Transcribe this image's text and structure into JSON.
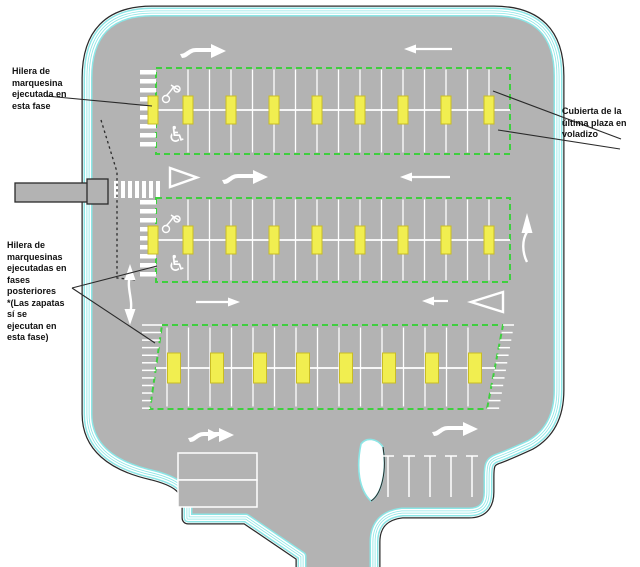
{
  "colors": {
    "gray": "#b3b3b3",
    "cyan": "#8ce6e6",
    "green": "#3ecf3e",
    "yellow": "#f1ee50",
    "yellow_border": "#c9bc24",
    "line": "#2a2a2a",
    "white": "#ffffff",
    "text": "#111111"
  },
  "icons": {
    "wheelchair": "♿"
  },
  "annotations": {
    "canopy_this_phase": {
      "lines": [
        "Hilera de",
        "marquesina",
        "ejecutada en",
        "esta fase"
      ]
    },
    "canopy_later_phases": {
      "lines": [
        "Hilera de",
        "marquesinas",
        "ejecutadas en",
        "fases",
        "posteriores",
        "*(Las zapatas",
        "sí se",
        "ejecutan en",
        "esta fase)"
      ]
    },
    "cantilever_cover": {
      "lines": [
        "Cubierta de la",
        "última plaza en",
        "voladizo"
      ]
    }
  },
  "plan": {
    "site_path": "M 88,78 Q 88,12 152,12 L 494,12 Q 558,12 558,76 L 558,390 Q 558,428 530,444 Q 506,455 497,458 C 489,461 488,465 488,477 L 488,492 C 488,506 481,512 469,512 L 402,512 C 384,514 374,524 374,542 L 374,580 L 302,580 L 302,556 L 246,518 L 188,518 L 188,504 C 188,488 176,480 152,474 C 112,465 88,446 88,414 Z",
    "rows": [
      {
        "type": "rect",
        "x1": 156,
        "y1": 68,
        "x2": 510,
        "y2": 154,
        "cy": 110,
        "div_start": 188,
        "div_gap": 21.5,
        "div_end": 490,
        "posts": [
          153,
          188,
          231,
          274,
          317,
          360,
          403,
          446,
          489
        ],
        "post_w": 10,
        "post_h": 28,
        "hatch": {
          "x": 140,
          "w": 16
        },
        "symbols": {
          "moto": [
            172,
            92
          ],
          "wheel": [
            177,
            134
          ]
        }
      },
      {
        "type": "rect",
        "x1": 156,
        "y1": 198,
        "x2": 510,
        "y2": 282,
        "cy": 240,
        "div_start": 188,
        "div_gap": 21.5,
        "div_end": 490,
        "posts": [
          153,
          188,
          231,
          274,
          317,
          360,
          403,
          446,
          489
        ],
        "post_w": 10,
        "post_h": 28,
        "hatch": {
          "x": 140,
          "w": 16
        },
        "symbols": {
          "moto": [
            172,
            222
          ],
          "wheel": [
            177,
            263
          ]
        }
      },
      {
        "type": "trap",
        "pts": [
          [
            162,
            325
          ],
          [
            503,
            325
          ],
          [
            487,
            409
          ],
          [
            150,
            409
          ]
        ],
        "cy": 368,
        "div_start": 167,
        "div_gap": 21.5,
        "div_end": 486,
        "posts": [
          174,
          217,
          260,
          303,
          346,
          389,
          432,
          475
        ],
        "post_w": 13,
        "post_h": 30,
        "hatch_wedges": [
          [
            [
              142,
              325
            ],
            [
              162,
              325
            ],
            [
              150,
              409
            ],
            [
              142,
              409
            ]
          ],
          [
            [
              503,
              325
            ],
            [
              514,
              325
            ],
            [
              499,
              409
            ],
            [
              487,
              409
            ]
          ]
        ]
      }
    ],
    "arrows": {
      "s_right": [
        [
          180,
          42
        ],
        [
          222,
          168
        ],
        [
          432,
          420
        ]
      ],
      "s_double_right": [
        [
          188,
          426
        ]
      ],
      "line_left": [
        [
          452,
          49,
          404
        ],
        [
          450,
          177,
          400
        ],
        [
          448,
          301,
          422
        ]
      ],
      "line_right": [
        [
          196,
          302,
          240
        ]
      ],
      "tri_right": "170,168 170,187 197,177.5",
      "tri_left": "503,292 503,312 471,302",
      "up_arrow": {
        "x": 527,
        "y_tip": 213,
        "y_tail": 262
      },
      "double_v": {
        "x": 130,
        "y_top": 264,
        "y_bot": 325
      }
    },
    "crosswalk": {
      "x": 114,
      "y": 181,
      "h": 17,
      "bar_w": 4,
      "gap": 7,
      "count": 7
    },
    "dotted": "101,120 117,172 117,278 137,280",
    "leaders": [
      [
        46,
        96,
        152,
        106
      ],
      [
        72,
        288,
        157,
        266
      ],
      [
        72,
        288,
        155,
        343
      ],
      [
        493,
        91,
        621,
        139
      ],
      [
        498,
        130,
        620,
        149
      ]
    ],
    "building": {
      "x": 178,
      "y": 453,
      "w": 79,
      "h": 27
    },
    "stalls": {
      "xs": [
        388,
        409,
        430,
        451,
        472
      ],
      "y1": 456,
      "y2": 497,
      "cap": 6
    },
    "island": "M 361,444 C 356,468 359,490 371,501 C 382,494 387,470 383,447 C 377,438 366,437 361,444 Z",
    "island_edge": "M 383,447 C 387,470 382,494 371,501",
    "bar": {
      "x": 15,
      "y": 183,
      "w": 90,
      "h": 19,
      "sq": [
        87,
        179,
        21,
        25
      ]
    }
  }
}
